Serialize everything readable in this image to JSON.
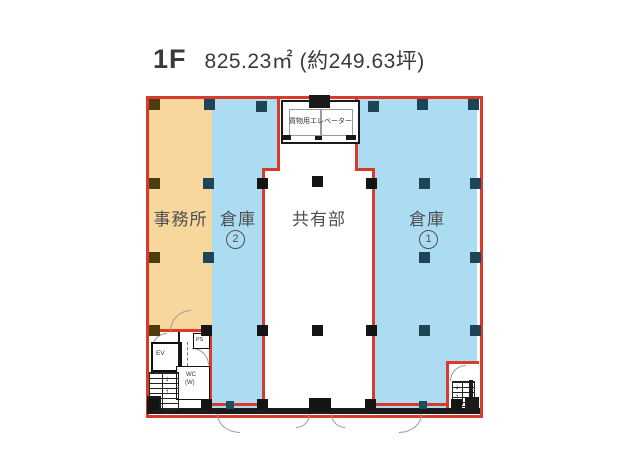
{
  "title": {
    "floor_label": "1F",
    "area_label": "825.23㎡ (約249.63坪)"
  },
  "rooms": {
    "office": {
      "label": "事務所"
    },
    "warehouse2": {
      "label": "倉庫",
      "number": "2"
    },
    "common": {
      "label": "共有部"
    },
    "warehouse1": {
      "label": "倉庫",
      "number": "1"
    }
  },
  "fixtures": {
    "freight_elevator": "貨物用エレベーター",
    "elevator": "EV",
    "pipe_space": "PS",
    "toilet": "WC",
    "toilet_sub": "(W)",
    "stairs_up": "↑",
    "stairs_down": "↓"
  },
  "colors": {
    "office_fill": "#f8d79c",
    "warehouse_fill": "#abdcf2",
    "boundary_wall_red": "#d93b2b",
    "wall_black": "#1a1a1a",
    "column_navy": "#1d4557",
    "column_olive": "#4d3d0d",
    "label_gray": "#4f4f4f"
  }
}
